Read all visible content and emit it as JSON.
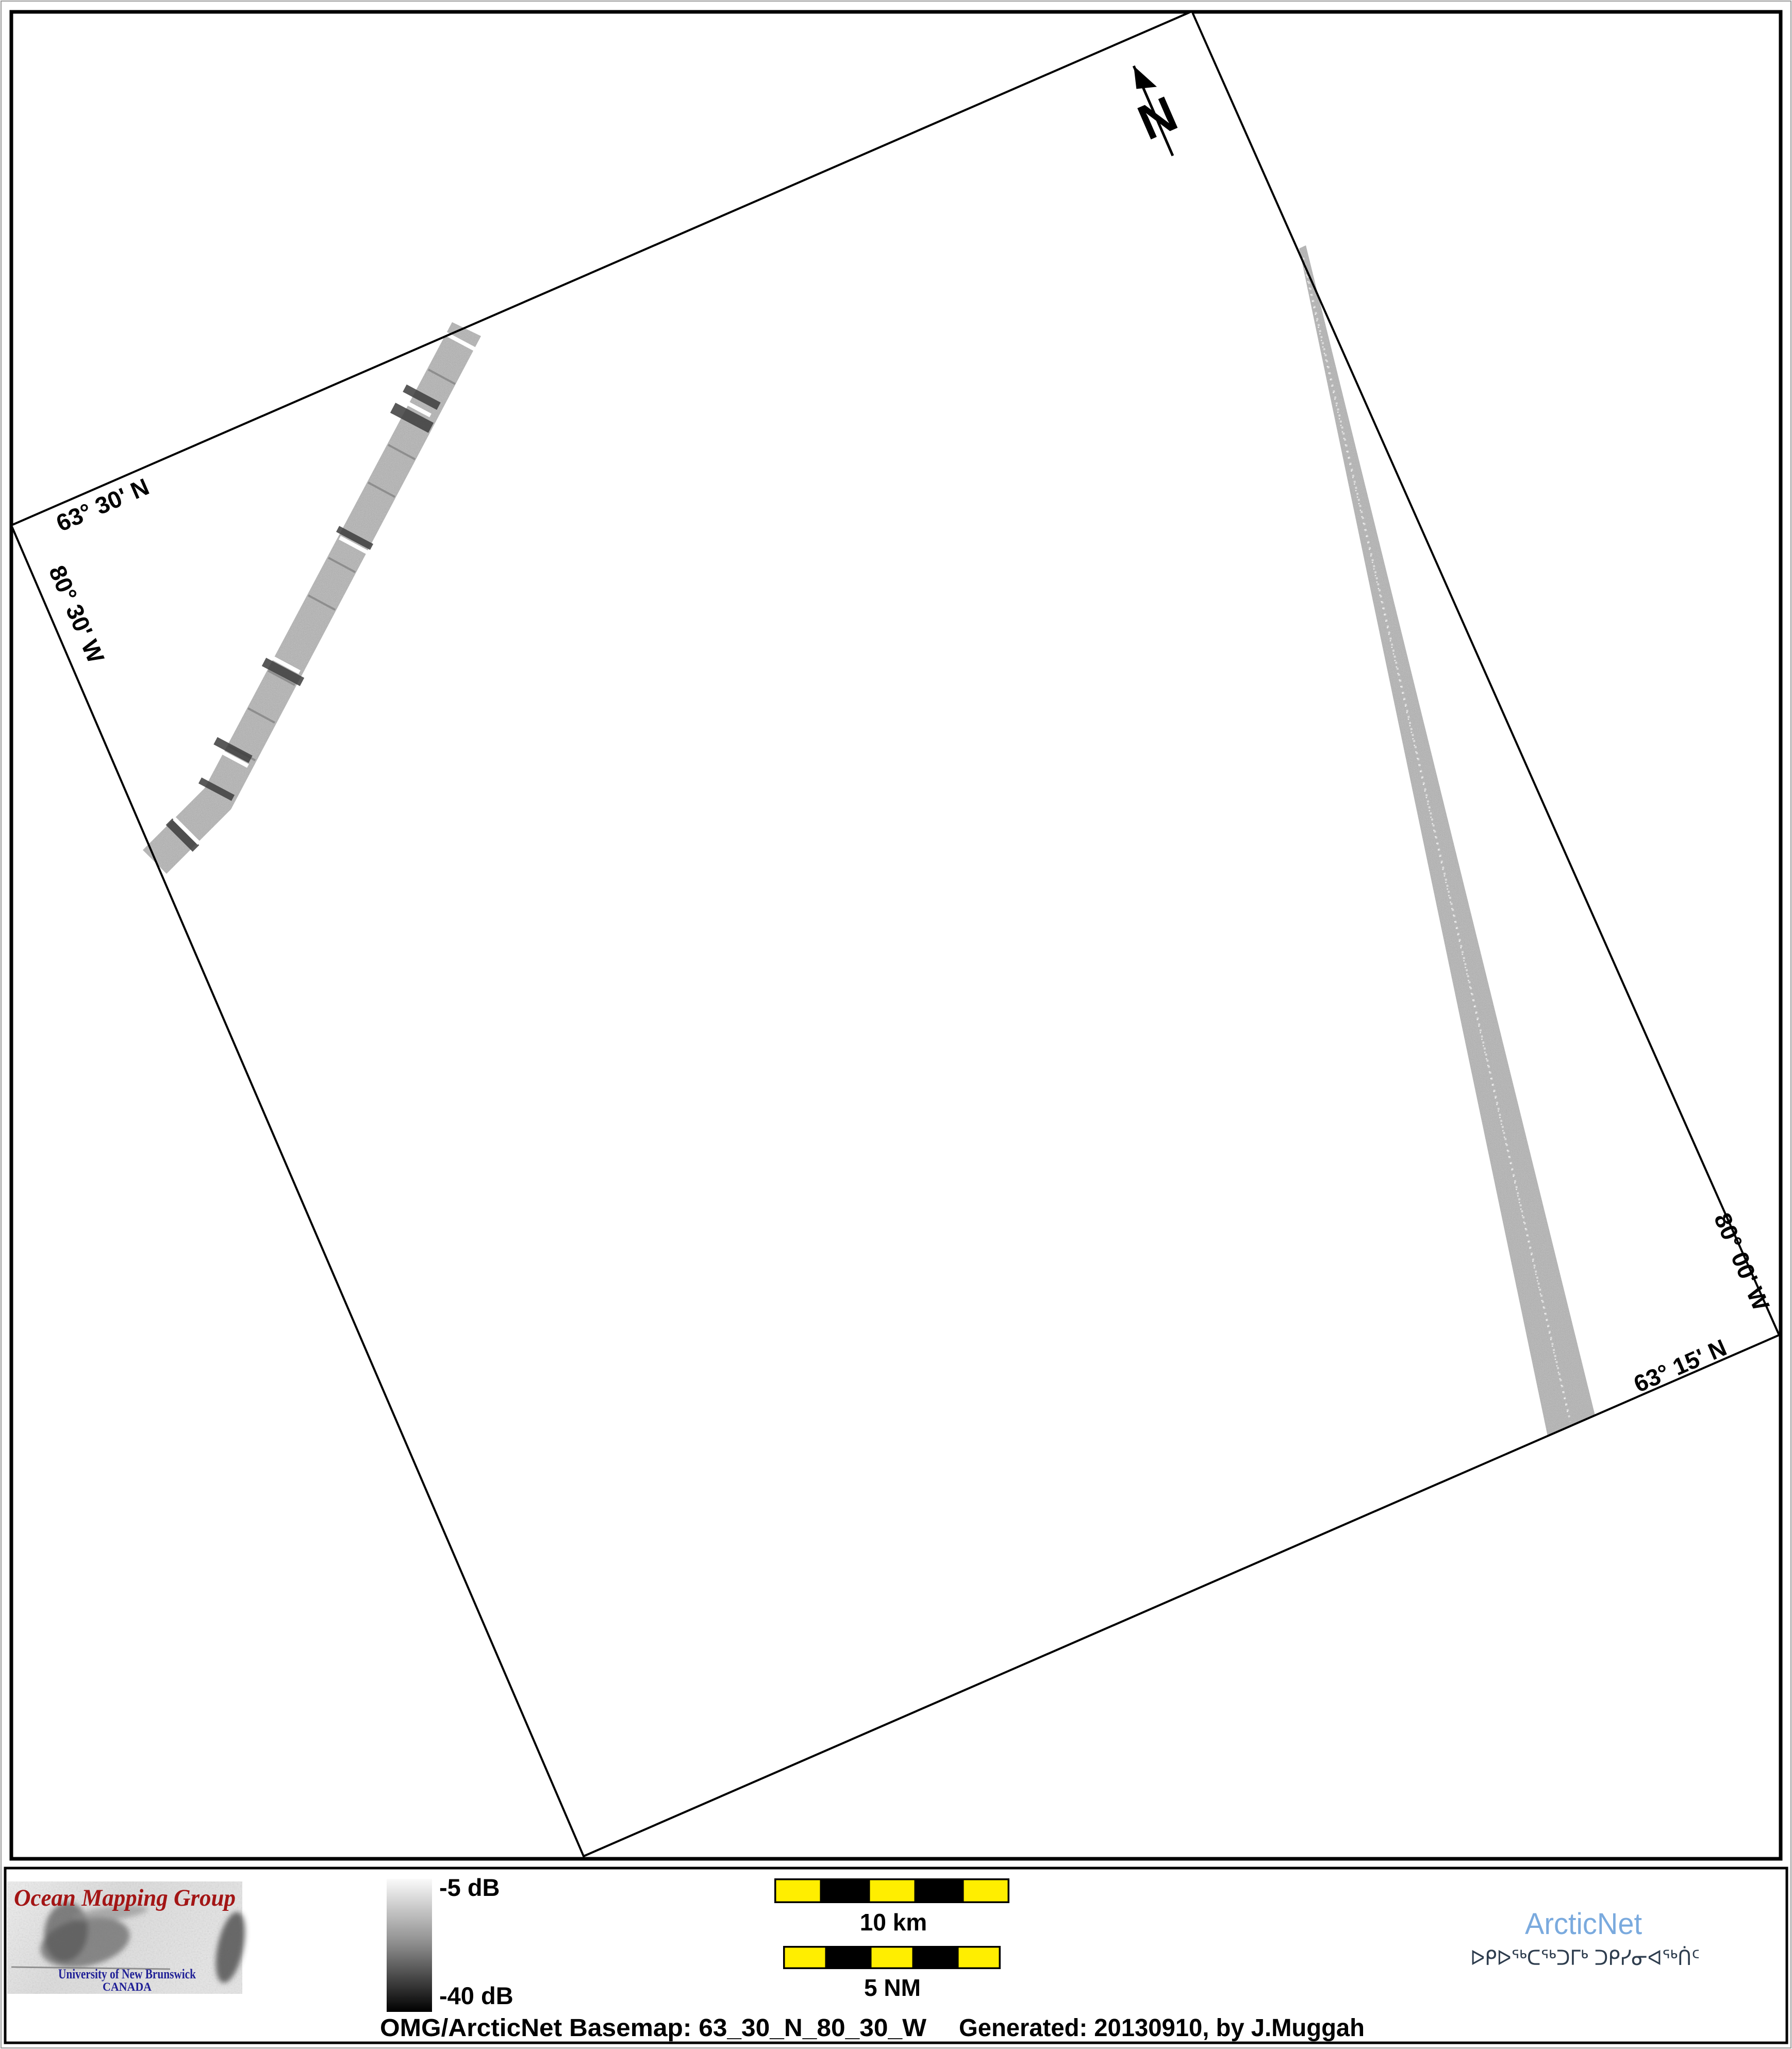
{
  "map": {
    "north_label": "N",
    "labels": {
      "top_lat": "63° 30' N",
      "left_lon": "80° 30' W",
      "right_lon": "80° 00' W",
      "bottom_lat": "63° 15' N"
    },
    "swath_color": "#b3b3b3",
    "boundary_color": "#000000"
  },
  "footer": {
    "logo": {
      "title": "Ocean Mapping Group",
      "org": "University of New Brunswick",
      "country": "CANADA",
      "title_color": "#a31515",
      "org_color": "#1f1f96"
    },
    "colorbar": {
      "top_label": "-5 dB",
      "bottom_label": "-40 dB",
      "top_color": "#fafafa",
      "bottom_color": "#000000"
    },
    "scalebars": {
      "km_label": "10 km",
      "nm_label": "5 NM",
      "segment_yellow": "#ffee00",
      "segment_black": "#000000"
    },
    "arcticnet": {
      "name": "ArcticNet",
      "tagline": "ᐅᑭᐅᖅᑕᖅᑐᒥᒃ ᑐᑭᓯᓂᐊᖅᑏᑦ",
      "name_color": "#7aaade",
      "tagline_color": "#2e3d4e"
    },
    "caption": {
      "basemap": "OMG/ArcticNet Basemap: 63_30_N_80_30_W",
      "generated": "Generated: 20130910, by J.Muggah"
    }
  }
}
